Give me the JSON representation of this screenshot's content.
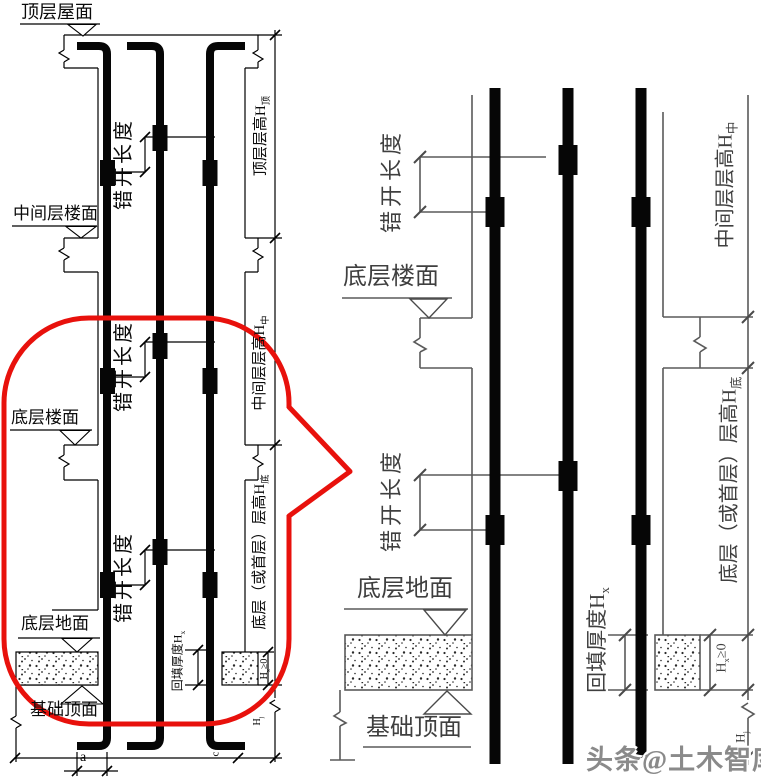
{
  "watermark": "头条@土木智库",
  "colors": {
    "callout_red": "#e8110c",
    "left_line": "#000000",
    "right_line": "#555555",
    "watermark_gray": "#8a8a8a"
  },
  "left": {
    "roof": "顶层屋面",
    "mid_floor": "中间层楼面",
    "bottom_floor": "底层楼面",
    "ground": "底层地面",
    "foundation": "基础顶面",
    "stagger": "错开长度",
    "backfill": {
      "text": "回填厚度H",
      "sub": "x"
    },
    "hx0": {
      "text": "H",
      "sub": "x",
      "tail": "≥0"
    },
    "story_top": {
      "text": "顶层层高H",
      "sub": "顶"
    },
    "story_mid": {
      "text": "中间层层高H",
      "sub": "中"
    },
    "story_bottom": {
      "text": "底层（或首层）层高H",
      "sub": "底"
    },
    "hj": {
      "text": "H",
      "sub": "j"
    },
    "dim_a": "a",
    "dim_c": "c"
  },
  "right": {
    "bottom_floor": "底层楼面",
    "ground": "底层地面",
    "foundation": "基础顶面",
    "stagger": "错开长度",
    "backfill": {
      "text": "回填厚度H",
      "sub": "x"
    },
    "hx0": {
      "text": "H",
      "sub": "x",
      "tail": "≥0"
    },
    "story_mid": {
      "text": "中间层层高H",
      "sub": "中"
    },
    "story_bottom": {
      "text": "底层（或首层）层高H",
      "sub": "底"
    },
    "hj": {
      "text": "H",
      "sub": "j"
    }
  }
}
